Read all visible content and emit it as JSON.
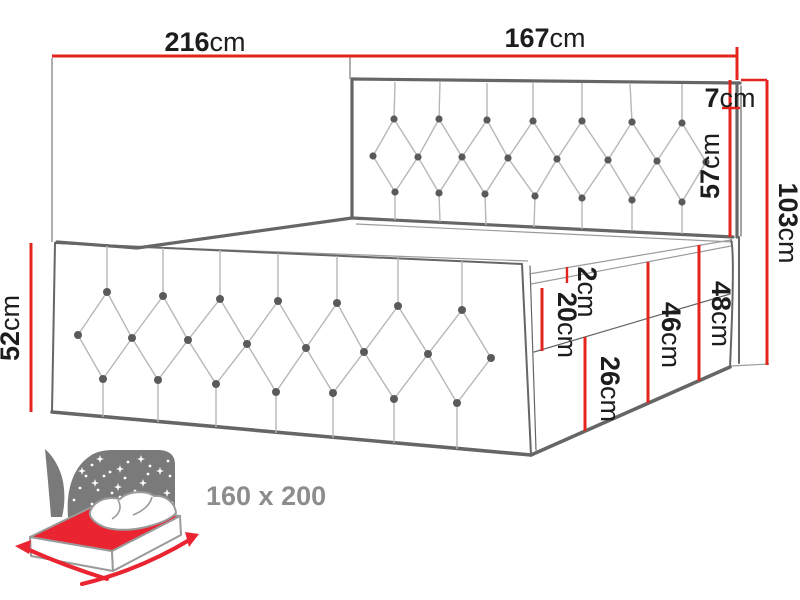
{
  "dimensions": {
    "total_length": {
      "value": "216",
      "unit": "cm"
    },
    "headboard_width": {
      "value": "167",
      "unit": "cm"
    },
    "headboard_top_offset": {
      "value": "7",
      "unit": "cm"
    },
    "headboard_above_surface": {
      "value": "57",
      "unit": "cm"
    },
    "headboard_total_height": {
      "value": "103",
      "unit": "cm"
    },
    "front_panel_height": {
      "value": "52",
      "unit": "cm"
    },
    "topper_thickness": {
      "value": "2",
      "unit": "cm"
    },
    "mattress_thickness": {
      "value": "20",
      "unit": "cm"
    },
    "height_to_mattress_top": {
      "value": "46",
      "unit": "cm"
    },
    "height_to_topper_top": {
      "value": "48",
      "unit": "cm"
    },
    "base_height": {
      "value": "26",
      "unit": "cm"
    }
  },
  "badge": {
    "size_label": "160 x 200"
  },
  "colors": {
    "dimension_red": "#e3251d",
    "icon_red": "#ea2430",
    "line_dark": "#666666",
    "line_light": "#9b9b9b",
    "tuft_line": "#b7b7b7",
    "button_gray": "#5a5a5a",
    "text_dark": "#1d1d1d",
    "muted_gray": "#8d8d8d",
    "icon_backdrop": "#7a7a7a"
  }
}
